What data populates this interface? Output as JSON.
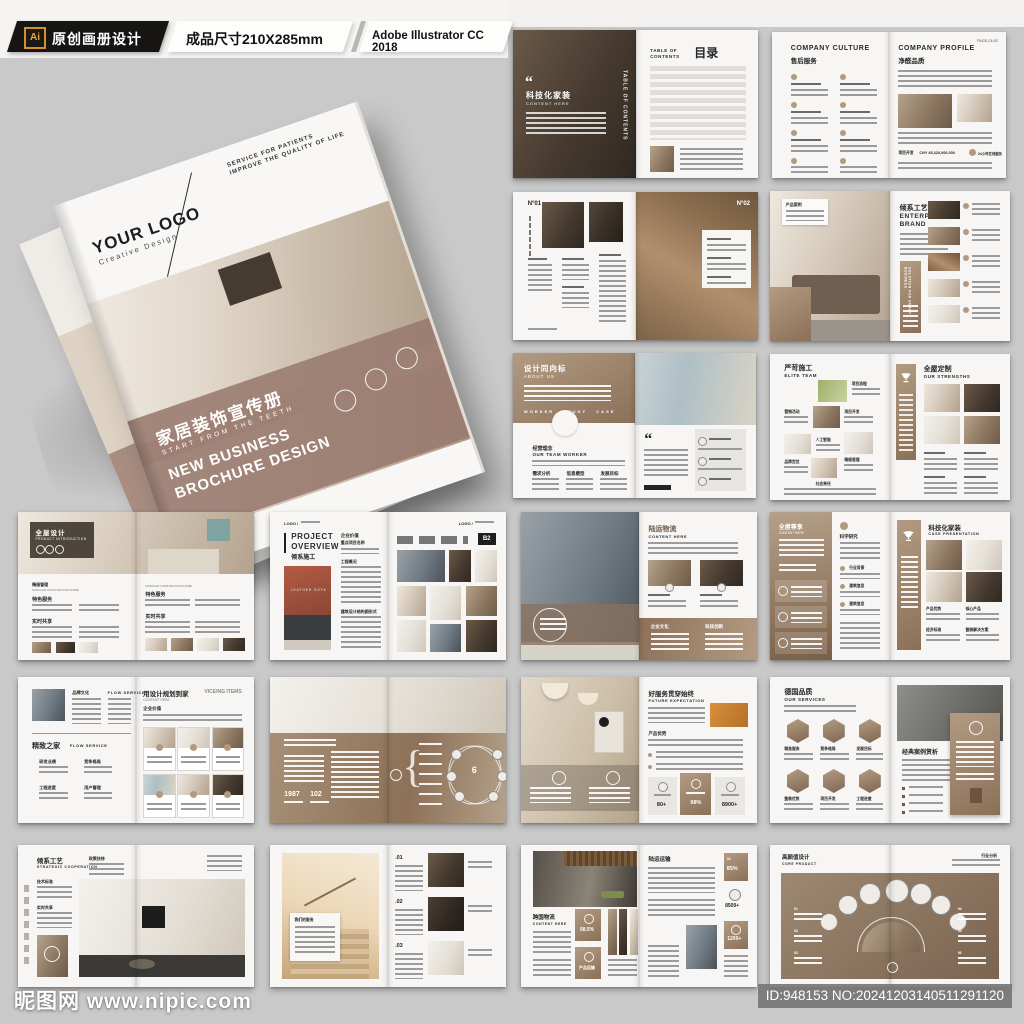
{
  "header": {
    "ai": "Ai",
    "tag": "原创画册设计",
    "size": "成品尺寸210X285mm",
    "app": "Adobe Illustrator CC 2018"
  },
  "cover": {
    "logo": "YOUR LOGO",
    "logo_sub": "Creative Design",
    "tag1": "SERVICE FOR PATIENTS",
    "tag2": "IMPROVE THE QUALITY OF LIFE",
    "title": "家居装饰宣传册",
    "sub": "START FROM THE TEETH",
    "en1": "NEW BUSINESS",
    "en2": "BROCHURE DESIGN"
  },
  "wm": {
    "site": "昵图网",
    "url": "www.nipic.com",
    "id": "ID:948153 NO:20241203140511291120"
  },
  "s1": {
    "q": "“",
    "cn": "科技化家装",
    "en": "CONTENT HERE",
    "vert": "TABLE OF CONTENTS",
    "toc_en": "TABLE OF CONTENTS",
    "toc_cn": "目录"
  },
  "s2": {
    "lt": "COMPANY CULTURE",
    "ls": "售后服务",
    "rt": "COMPANY PROFILE",
    "rs": "净醛品质",
    "pg": "PAGE-01/02",
    "a": "项目开发",
    "b": "CNY 45,320,000,000",
    "c": "24小时在线服务"
  },
  "s3": {
    "n1": "N°01",
    "n2": "N°02"
  },
  "s4": {
    "card": "产品案例",
    "cn": "倾系工艺",
    "en": "ENTERPSE BRAND",
    "band": "SOLUTION FOR SMART BUSINESS"
  },
  "s5": {
    "cn": "设计同向标",
    "en": "ABOUT US",
    "tabs": "WORKER&nbsp;&nbsp;STUDY&nbsp;&nbsp;CASE",
    "tabs_plain": "WORKER   STUDY   CASE",
    "s_cn": "经营理念",
    "s_en": "OUR TEAM WORKER",
    "c1": "需求分析",
    "c2": "信息模型",
    "c3": "发展目标",
    "q": "“"
  },
  "s6": {
    "lcn": "严苛施工",
    "len": "ELITE TEAM",
    "rcn": "全屋定制",
    "ren": "OUR STRENGTHS",
    "g1": "项目流程",
    "g2": "营销活动",
    "g3": "项目开发",
    "g4": "人工智能",
    "g5": "精细管理",
    "g6": "品牌定位",
    "g7": "社会责任"
  },
  "s7": {
    "cn": "全屋设计",
    "en": "PRODUCT INTRODUCTION",
    "h1": "精细管理",
    "h2": "MODULAR CONSTRUCTION HOME",
    "a": "特色服务",
    "b": "实时共享"
  },
  "s8": {
    "logo": "LOGO /",
    "e1": "PROJECT",
    "e2": "OVERVIEW",
    "cn": "倾系施工",
    "cap": "LEATHER SOFA",
    "c1": "企业价值",
    "c1b": "重点项目名称",
    "c2": "工程概况",
    "c3": "建筑设计结构图形式",
    "badge": "B2"
  },
  "s9": {
    "cn": "陆运物流",
    "en": "CONTENT HERE",
    "b1": "企业文化",
    "b2": "科技创新"
  },
  "s10": {
    "cn": "全屋尊享",
    "en": "CONTENT HERE",
    "rh": "科学研究",
    "i1": "行业背景",
    "i2": "建筑信息",
    "i3": "建筑信息",
    "pcn": "科技化家装",
    "pen": "CASE PRESENTATION",
    "c1": "产品优势",
    "c2": "核心产品",
    "c3": "经济标准",
    "c4": "整装解决方案"
  },
  "s11": {
    "h1": "品牌文化",
    "h2": "FLOW SERVICE",
    "cn": "精致之家",
    "en": "FLOW SERVICE",
    "i1": "研发业绩",
    "i2": "竞争格局",
    "i3": "工程进度",
    "i4": "用户管理",
    "rcn": "用设计规划到家",
    "ren": "VICEING ITEMS",
    "rsub": "CONTENT HERE",
    "rh": "企业价值"
  },
  "s12": {
    "y1": "1987",
    "y2": "102",
    "n": "6"
  },
  "s13": {
    "cn": "好服务贯穿始终",
    "en": "FUTURE EXPECTATION",
    "h": "产品优势",
    "v1": "80+",
    "v2": "98%",
    "v3": "8900+"
  },
  "s14": {
    "cn": "德国品质",
    "en": "OUR SERVICES",
    "h1": "精准服务",
    "h2": "竞争格局",
    "h3": "发展目标",
    "h4": "整装优势",
    "h5": "项目开发",
    "h6": "工程进度",
    "rt": "经典案例赏析"
  },
  "s15": {
    "cn": "倾系工艺",
    "en": "STRATEGIC COOPERATION",
    "a": "政策扶持",
    "b": "技术标准",
    "c": "实时共享"
  },
  "s16": {
    "box": "我们的服务",
    "n1": ".01",
    "n2": ".02",
    "n3": ".03"
  },
  "s17": {
    "cn": "跨国物流",
    "en": "CONTENT HERE",
    "pct": "98.5%",
    "b2": "产品运输",
    "rcn": "陆运运输",
    "r1": "01",
    "r1v": "85%",
    "r2": "8500+",
    "r3": "1200+"
  },
  "s18": {
    "cn": "高颜值设计",
    "en": "CORE PRODUCT",
    "r": "行业分析",
    "n1": "01",
    "n2": "02",
    "n3": "03",
    "n4": "04",
    "n5": "05",
    "n6": "06"
  }
}
